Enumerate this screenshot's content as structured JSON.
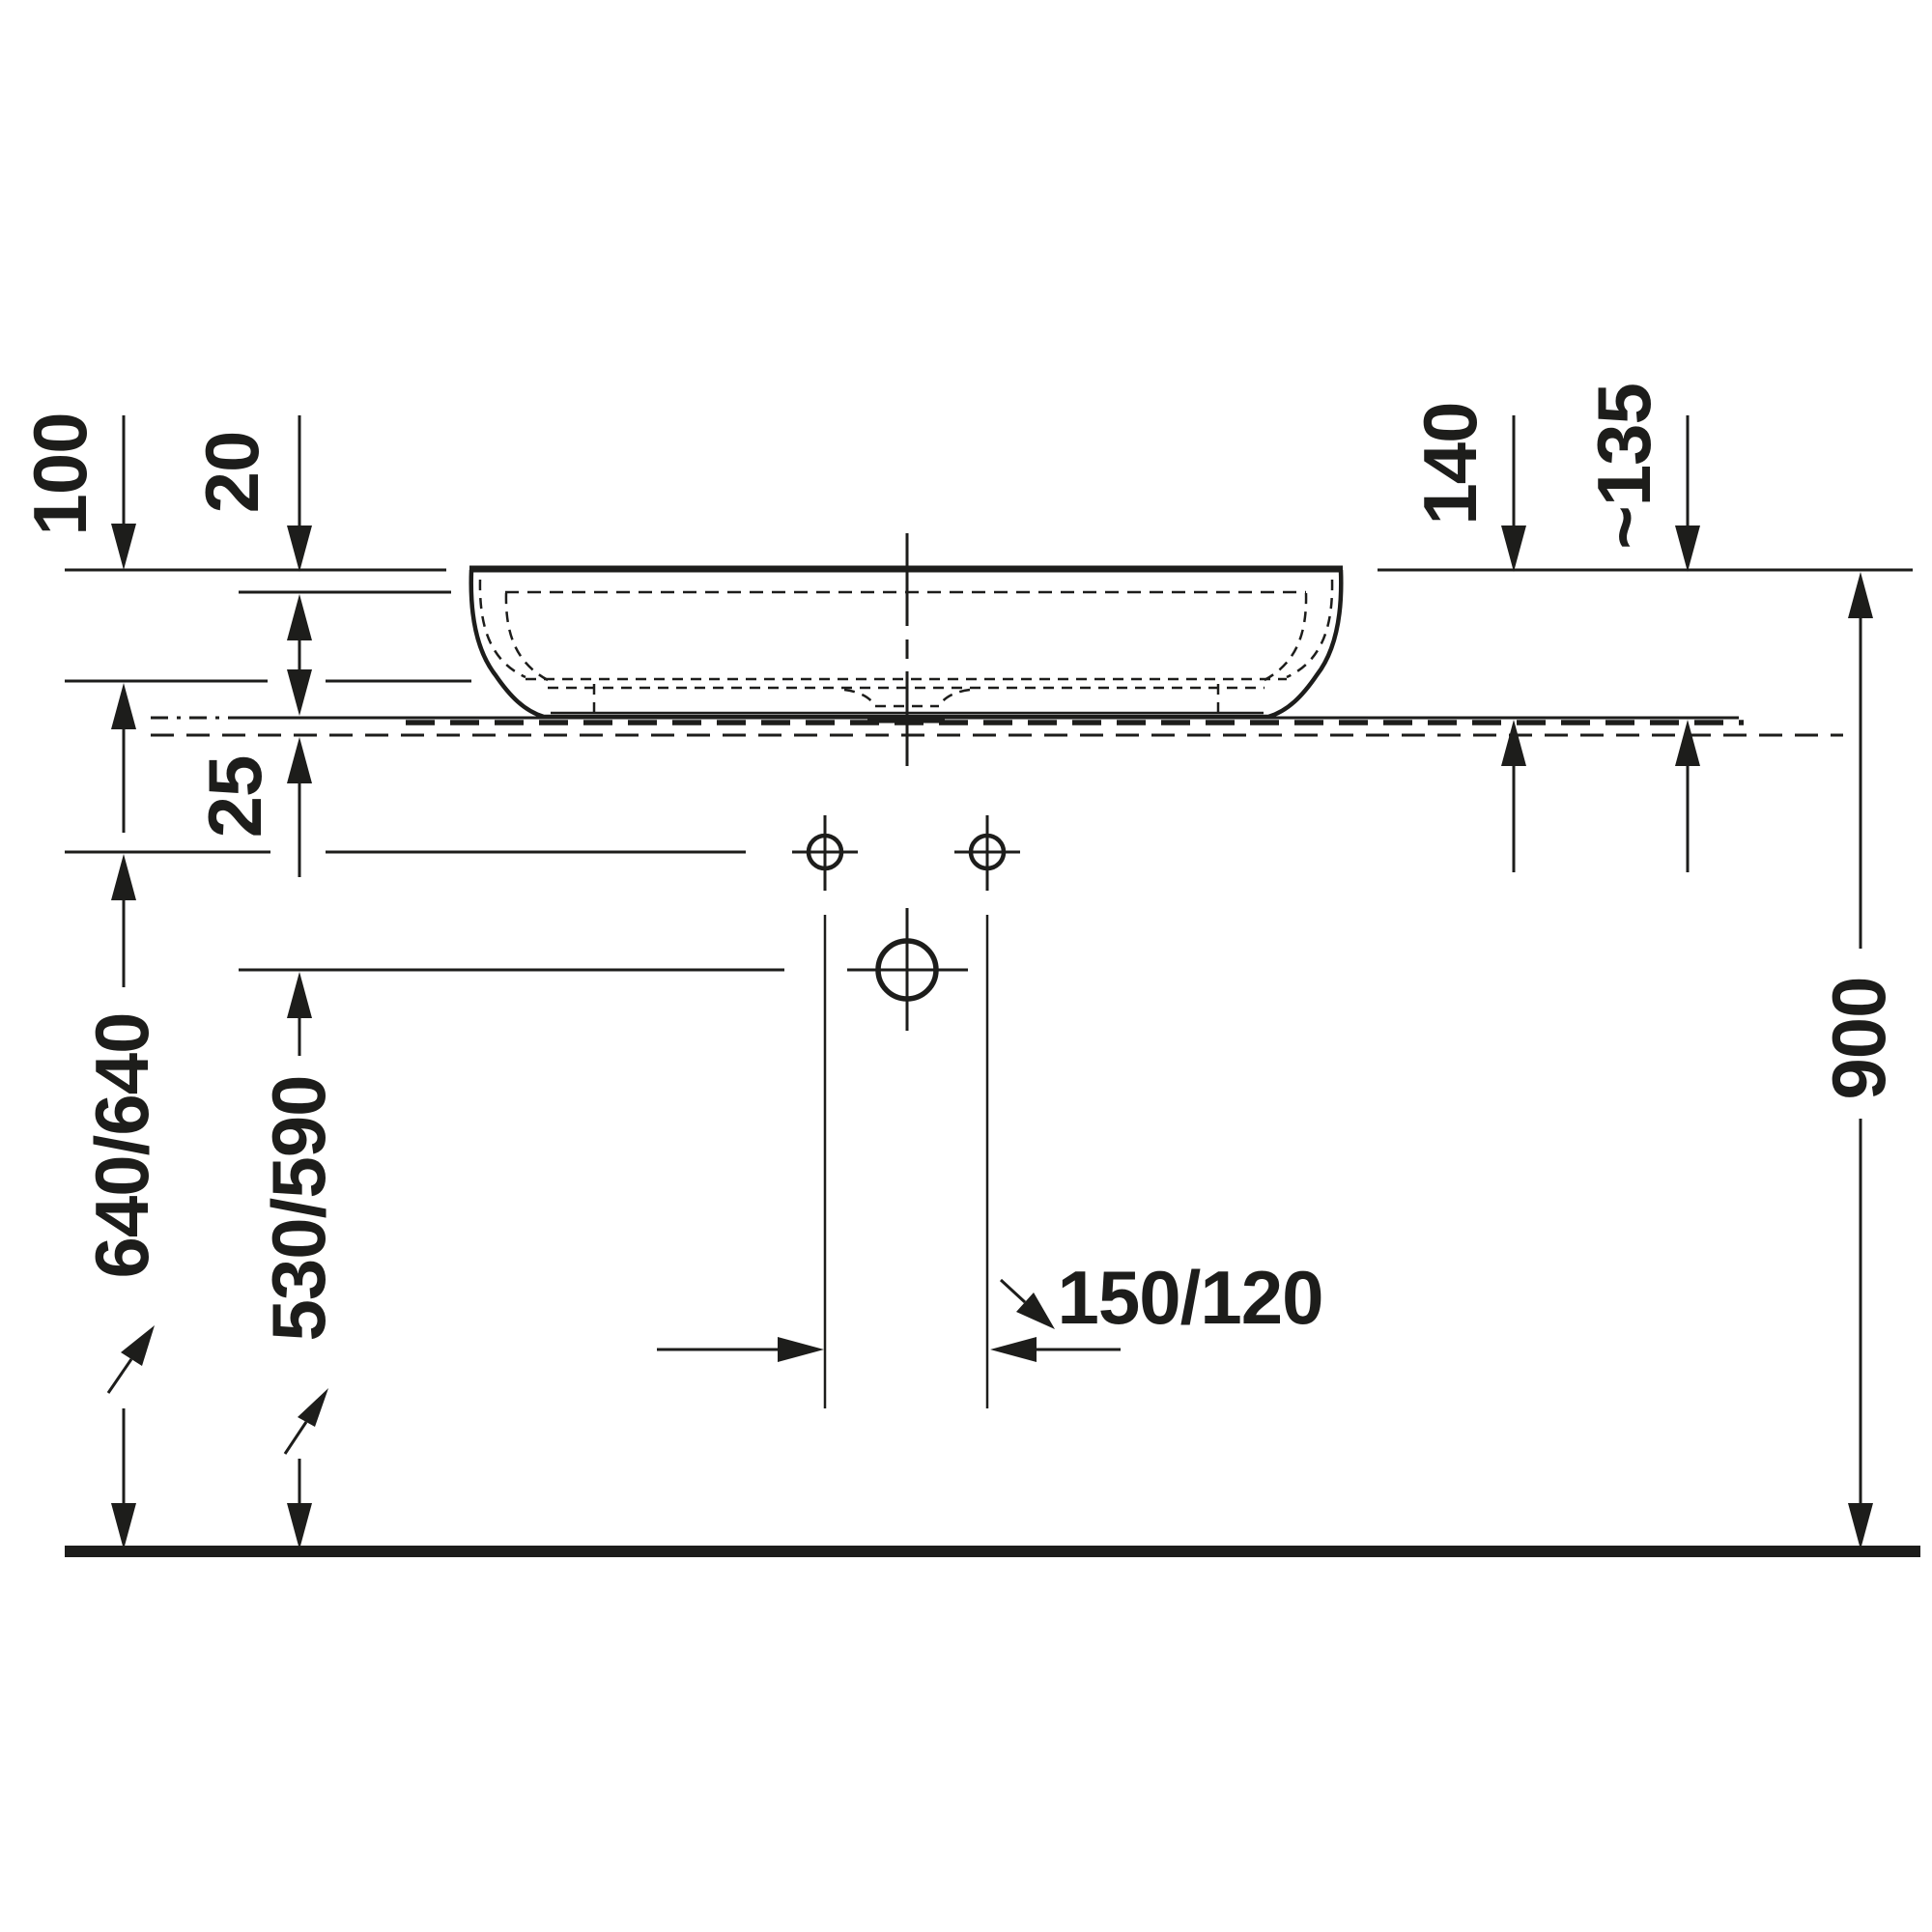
{
  "drawing": {
    "kind": "technical-dimension-drawing",
    "subject": "countertop washbasin side elevation",
    "line_color": "#1d1d1b",
    "background_color": "#ffffff"
  },
  "dimensions": {
    "bowl_depth": {
      "label": "100"
    },
    "rim_thickness": {
      "label": "20"
    },
    "counter_offset": {
      "label": "25"
    },
    "basin_height": {
      "label": "140"
    },
    "height_installed": {
      "label": "~135"
    },
    "faucet_hole_height": {
      "label": "640/640"
    },
    "mixer_hole_height": {
      "label": "530/590"
    },
    "faucet_spacing": {
      "label": "150/120"
    },
    "rim_height": {
      "label": "900"
    }
  }
}
